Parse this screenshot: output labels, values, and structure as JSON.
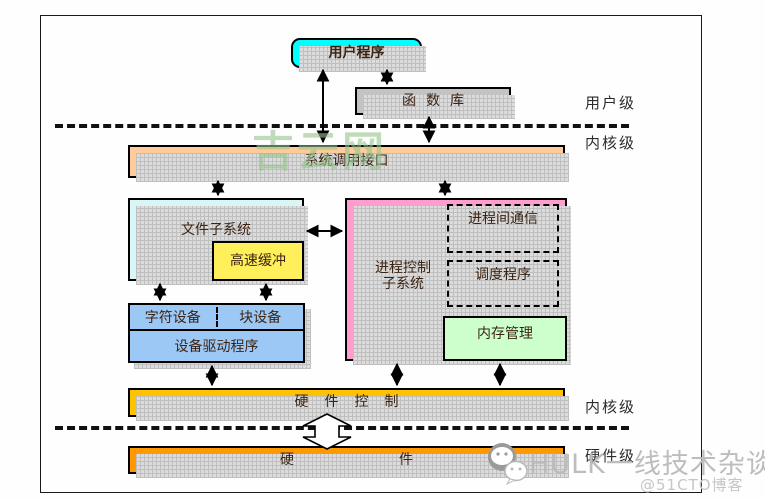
{
  "diagram": {
    "boxes": {
      "user_program": "用户程序",
      "function_library": "函数库",
      "syscall_interface": "系统调用接口",
      "file_subsystem": "文件子系统",
      "buffer_cache": "高速缓冲",
      "process_subsystem_line1": "进程控制",
      "process_subsystem_line2": "子系统",
      "ipc": "进程间通信",
      "scheduler": "调度程序",
      "memory_management": "内存管理",
      "char_device": "字符设备",
      "block_device": "块设备",
      "device_driver": "设备驱动程序",
      "hardware_control": "硬件控制",
      "hardware": "硬件"
    },
    "levels": {
      "user_level": "用户级",
      "kernel_level_top": "内核级",
      "kernel_level_bottom": "内核级",
      "hardware_level": "硬件级"
    },
    "colors": {
      "user_program": "#00ffff",
      "function_library": "#c3c3c3",
      "syscall_interface": "#ffcc99",
      "file_subsystem": "#d9f6f6",
      "buffer_cache": "#ffef5a",
      "process_subsystem": "#ff9dce",
      "memory_management": "#ccffcc",
      "devices": "#9cc8f5",
      "hardware_control": "#ffc200",
      "hardware": "#ff9900"
    }
  },
  "watermarks": {
    "center": "吉云网",
    "bottom_text": "HULK一线技术杂谈",
    "bottom_handle": "@51CTO博客"
  }
}
